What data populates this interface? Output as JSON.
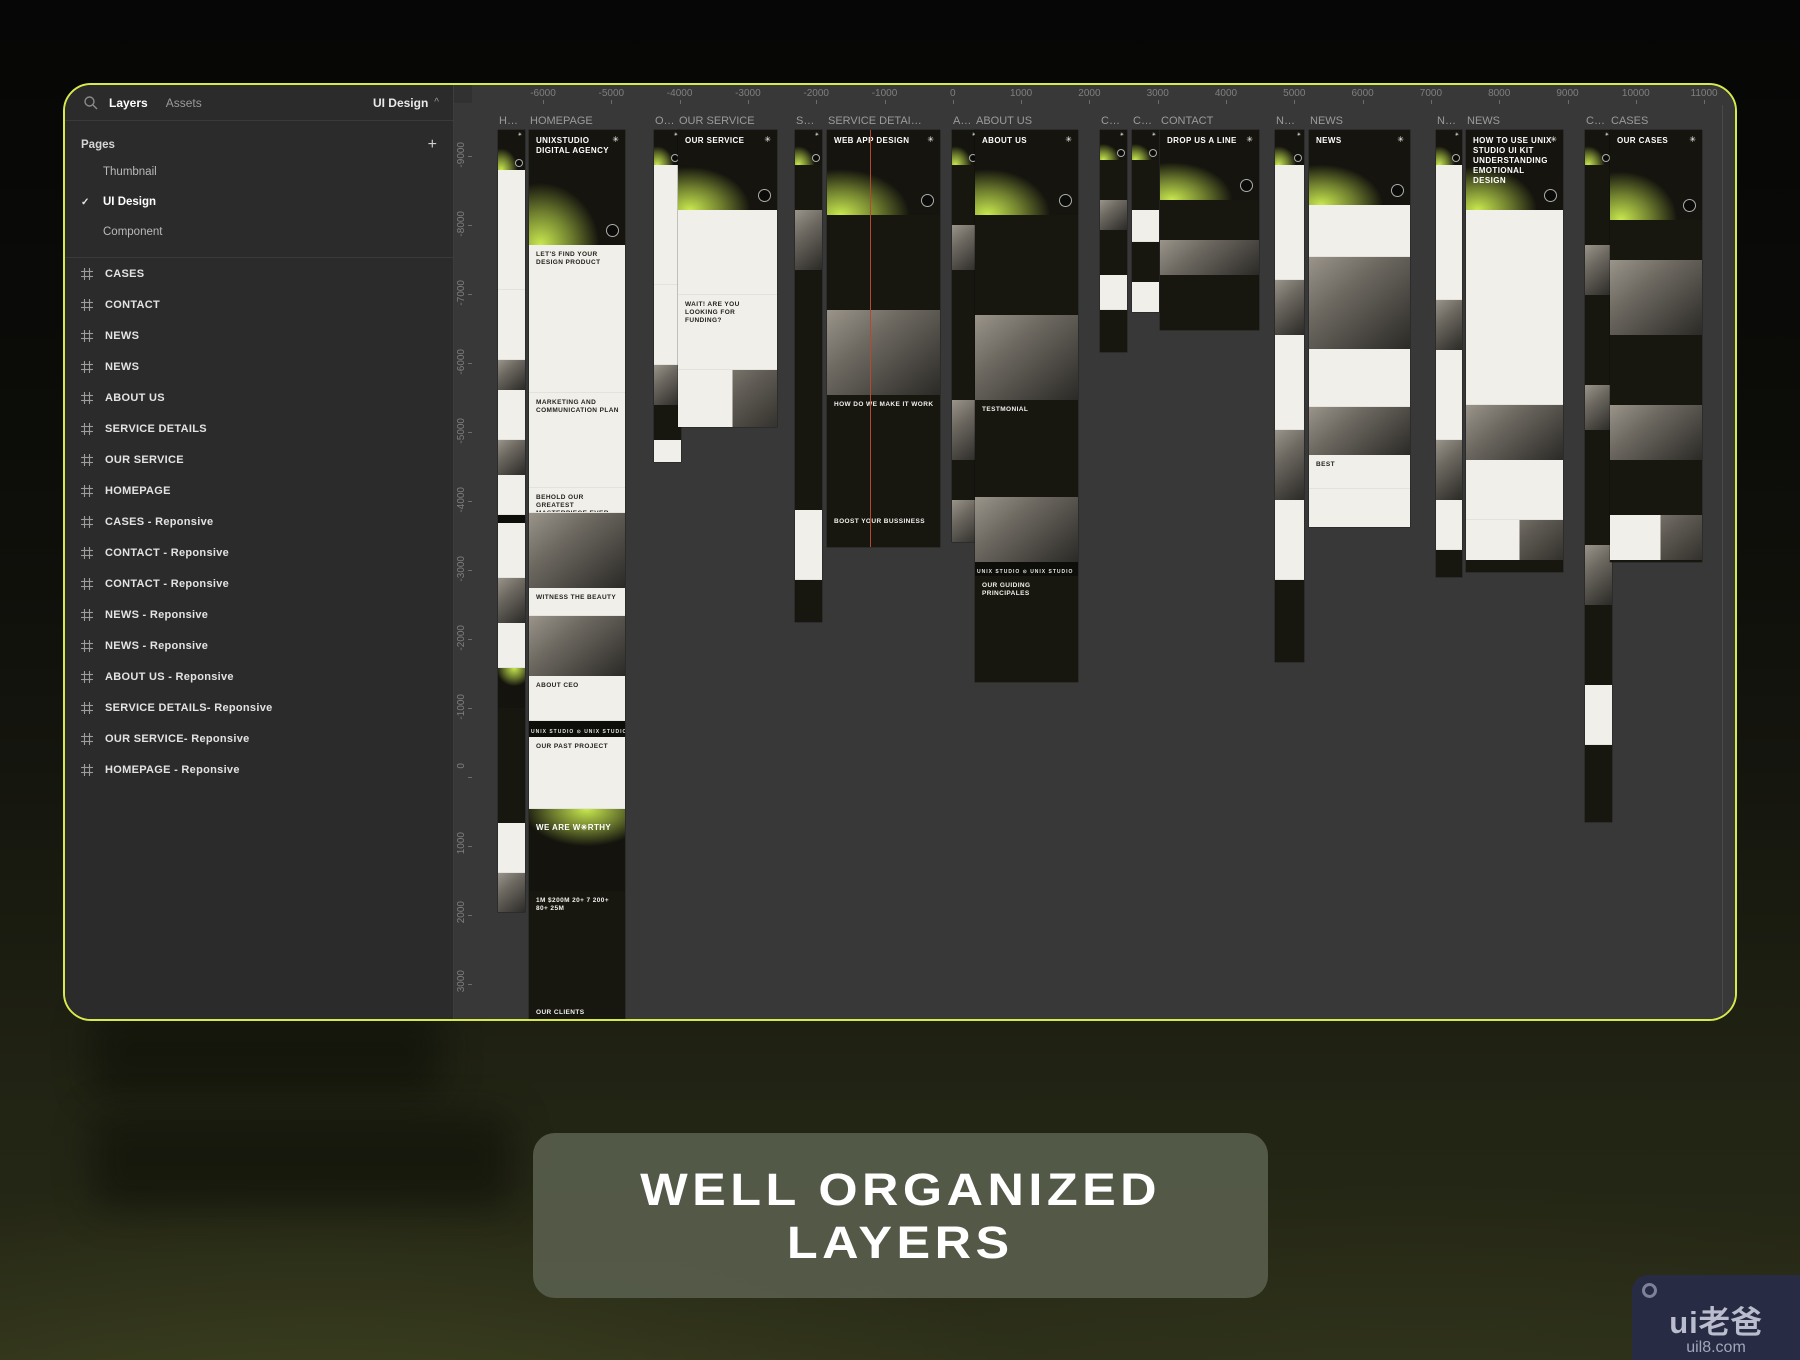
{
  "colors": {
    "accent_border": "#d8ea4b",
    "glow_lime": "#c9e94f",
    "canvas_bg": "#383838",
    "sidebar_bg": "#2b2b2b",
    "caption_bg": "#585d4c",
    "badge_bg": "#272b44",
    "guide_red": "#b34a2e"
  },
  "sidebar": {
    "tabs": {
      "layers": "Layers",
      "assets": "Assets"
    },
    "page_selector": {
      "value": "UI Design",
      "caret": "^"
    },
    "pages_header": {
      "title": "Pages",
      "add_label": "+"
    },
    "pages": [
      {
        "label": "Thumbnail",
        "selected": false
      },
      {
        "label": "UI Design",
        "selected": true
      },
      {
        "label": "Component",
        "selected": false
      }
    ],
    "check_glyph": "✓",
    "layers": [
      "CASES",
      "CONTACT",
      "NEWS",
      "NEWS",
      "ABOUT US",
      "SERVICE DETAILS",
      "OUR SERVICE",
      "HOMEPAGE",
      "CASES - Reponsive",
      "CONTACT - Reponsive",
      "CONTACT - Reponsive",
      "NEWS - Reponsive",
      "NEWS - Reponsive",
      "ABOUT US - Reponsive",
      "SERVICE DETAILS- Reponsive",
      "OUR SERVICE- Reponsive",
      "HOMEPAGE - Reponsive"
    ]
  },
  "canvas": {
    "h_ruler": {
      "start": -6000,
      "step": 1000,
      "count": 18,
      "first_x": 89,
      "spacing": 68.3
    },
    "v_ruler": {
      "start": -9000,
      "step": 1000,
      "count": 14,
      "first_y": 57,
      "spacing": 69
    },
    "star_glyph": "✳",
    "frames": [
      {
        "label": "H…",
        "x": 44,
        "y": 45,
        "w": 27,
        "h": 782,
        "mini": true,
        "segs": [
          [
            "gh",
            40
          ],
          [
            "l",
            120
          ],
          [
            "l",
            70
          ],
          [
            "p",
            30
          ],
          [
            "l",
            50
          ],
          [
            "p",
            35
          ],
          [
            "l",
            40
          ],
          [
            "m",
            8
          ],
          [
            "l",
            55
          ],
          [
            "p",
            45
          ],
          [
            "l",
            45
          ],
          [
            "g2",
            40
          ],
          [
            "d",
            70
          ],
          [
            "d",
            45
          ],
          [
            "l",
            50
          ],
          [
            "p",
            40
          ],
          [
            "l",
            40
          ]
        ]
      },
      {
        "label": "HOMEPAGE",
        "x": 75,
        "y": 45,
        "w": 96,
        "h": 893,
        "segs": [
          [
            "gh",
            115,
            "UNIXSTUDIO DIGITAL AGENCY"
          ],
          [
            "l",
            148,
            "LET'S FIND YOUR DESIGN PRODUCT"
          ],
          [
            "l",
            95,
            "MARKETING AND COMMUNICATION PLAN"
          ],
          [
            "l",
            25,
            "BEHOLD OUR GREATEST MASTERPIECE EVER"
          ],
          [
            "p",
            75
          ],
          [
            "l",
            28,
            "WITNESS THE BEAUTY"
          ],
          [
            "p",
            60
          ],
          [
            "l",
            45,
            "ABOUT CEO"
          ],
          [
            "m",
            16,
            "UNIX STUDIO ⊙ UNIX STUDIO ⊙ UNIX STUDIO"
          ],
          [
            "l",
            72,
            "OUR PAST PROJECT"
          ],
          [
            "g2",
            82,
            "WE ARE W✳RTHY"
          ],
          [
            "d",
            112,
            "1M   $200M   20+   7   200+   80+   25M"
          ],
          [
            "d",
            68,
            "OUR CLIENTS"
          ],
          [
            "d",
            60
          ],
          [
            "lp",
            60
          ]
        ]
      },
      {
        "label": "O…",
        "x": 200,
        "y": 45,
        "w": 27,
        "h": 332,
        "mini": true,
        "segs": [
          [
            "gh",
            35
          ],
          [
            "l",
            120
          ],
          [
            "l",
            80
          ],
          [
            "p",
            40
          ],
          [
            "d",
            35
          ],
          [
            "l",
            25
          ]
        ]
      },
      {
        "label": "OUR SERVICE",
        "x": 224,
        "y": 45,
        "w": 99,
        "h": 297,
        "segs": [
          [
            "gh",
            80,
            "OUR SERVICE"
          ],
          [
            "l",
            85
          ],
          [
            "l",
            75,
            "WAIT! ARE YOU LOOKING FOR FUNDING?"
          ],
          [
            "lp",
            60
          ]
        ]
      },
      {
        "label": "S…",
        "x": 341,
        "y": 45,
        "w": 27,
        "h": 492,
        "mini": true,
        "segs": [
          [
            "gh",
            35
          ],
          [
            "d",
            45
          ],
          [
            "p",
            60
          ],
          [
            "d",
            150
          ],
          [
            "d",
            90
          ],
          [
            "l",
            70
          ],
          [
            "d",
            45
          ]
        ]
      },
      {
        "label": "SERVICE DETAI…",
        "x": 373,
        "y": 45,
        "w": 113,
        "h": 417,
        "guide": true,
        "segs": [
          [
            "gh",
            85,
            "WEB APP DESIGN"
          ],
          [
            "d",
            95
          ],
          [
            "p",
            85
          ],
          [
            "d",
            55,
            "HOW DO WE MAKE IT WORK"
          ],
          [
            "d",
            62
          ],
          [
            "d",
            35,
            "BOOST YOUR BUSSINESS"
          ]
        ]
      },
      {
        "label": "A…",
        "x": 498,
        "y": 45,
        "w": 27,
        "h": 412,
        "mini": true,
        "segs": [
          [
            "gh",
            35
          ],
          [
            "d",
            60
          ],
          [
            "p",
            45
          ],
          [
            "d",
            80
          ],
          [
            "d",
            50
          ],
          [
            "p",
            60
          ],
          [
            "d",
            40
          ],
          [
            "p",
            45
          ]
        ]
      },
      {
        "label": "ABOUT US",
        "x": 521,
        "y": 45,
        "w": 103,
        "h": 552,
        "segs": [
          [
            "gh",
            85,
            "ABOUT US"
          ],
          [
            "d",
            60
          ],
          [
            "d",
            40
          ],
          [
            "p",
            85
          ],
          [
            "d",
            42,
            "TESTMONIAL"
          ],
          [
            "d",
            55
          ],
          [
            "p",
            65
          ],
          [
            "m",
            14,
            "UNIX STUDIO ⊙ UNIX STUDIO"
          ],
          [
            "d",
            50,
            "OUR GUIDING PRINCIPALES"
          ],
          [
            "d",
            70
          ],
          [
            "lp",
            55
          ]
        ]
      },
      {
        "label": "C…",
        "x": 646,
        "y": 45,
        "w": 27,
        "h": 222,
        "mini": true,
        "segs": [
          [
            "gh",
            30
          ],
          [
            "d",
            40
          ],
          [
            "p",
            30
          ],
          [
            "d",
            45
          ],
          [
            "l",
            35
          ],
          [
            "d",
            45
          ]
        ]
      },
      {
        "label": "C…",
        "x": 678,
        "y": 45,
        "w": 27,
        "h": 182,
        "mini": true,
        "segs": [
          [
            "gh",
            30
          ],
          [
            "d",
            50
          ],
          [
            "l",
            32
          ],
          [
            "d",
            40
          ],
          [
            "l",
            32
          ]
        ]
      },
      {
        "label": "CONTACT",
        "x": 706,
        "y": 45,
        "w": 99,
        "h": 200,
        "segs": [
          [
            "gh",
            70,
            "DROP US A LINE"
          ],
          [
            "d",
            40
          ],
          [
            "p",
            35
          ],
          [
            "d",
            55
          ]
        ]
      },
      {
        "label": "N…",
        "x": 821,
        "y": 45,
        "w": 29,
        "h": 532,
        "mini": true,
        "segs": [
          [
            "gh",
            35
          ],
          [
            "l",
            115
          ],
          [
            "p",
            55
          ],
          [
            "l",
            95
          ],
          [
            "p",
            70
          ],
          [
            "l",
            80
          ],
          [
            "d",
            45
          ]
        ]
      },
      {
        "label": "NEWS",
        "x": 855,
        "y": 45,
        "w": 101,
        "h": 397,
        "segs": [
          [
            "gh",
            75,
            "NEWS"
          ],
          [
            "l",
            52
          ],
          [
            "p",
            92
          ],
          [
            "l",
            58
          ],
          [
            "p",
            48
          ],
          [
            "l",
            34,
            "BEST"
          ],
          [
            "l",
            40
          ]
        ]
      },
      {
        "label": "N…",
        "x": 982,
        "y": 45,
        "w": 26,
        "h": 447,
        "mini": true,
        "segs": [
          [
            "gh",
            35
          ],
          [
            "l",
            135
          ],
          [
            "p",
            50
          ],
          [
            "l",
            90
          ],
          [
            "p",
            60
          ],
          [
            "l",
            50
          ]
        ]
      },
      {
        "label": "NEWS",
        "x": 1012,
        "y": 45,
        "w": 97,
        "h": 442,
        "segs": [
          [
            "gh",
            80,
            "HOW TO USE UNIX STUDIO UI KIT UNDERSTANDING EMOTIONAL DESIGN"
          ],
          [
            "l",
            195
          ],
          [
            "p",
            55
          ],
          [
            "l",
            60
          ],
          [
            "lp",
            40
          ]
        ]
      },
      {
        "label": "C…",
        "x": 1131,
        "y": 45,
        "w": 27,
        "h": 692,
        "mini": true,
        "segs": [
          [
            "gh",
            35
          ],
          [
            "d",
            80
          ],
          [
            "p",
            50
          ],
          [
            "d",
            90
          ],
          [
            "p",
            45
          ],
          [
            "d",
            115
          ],
          [
            "p",
            60
          ],
          [
            "d",
            80
          ],
          [
            "l",
            60
          ],
          [
            "d",
            50
          ]
        ]
      },
      {
        "label": "CASES",
        "x": 1156,
        "y": 45,
        "w": 92,
        "h": 432,
        "segs": [
          [
            "gh",
            90,
            "OUR CASES"
          ],
          [
            "d",
            40
          ],
          [
            "p",
            75
          ],
          [
            "d",
            70
          ],
          [
            "p",
            55
          ],
          [
            "d",
            55
          ],
          [
            "lp",
            45
          ]
        ]
      }
    ]
  },
  "caption": {
    "line1": "WELL ORGANIZED",
    "line2": "LAYERS"
  },
  "badge": {
    "logo": "ui老爸",
    "url": "uil8.com"
  }
}
